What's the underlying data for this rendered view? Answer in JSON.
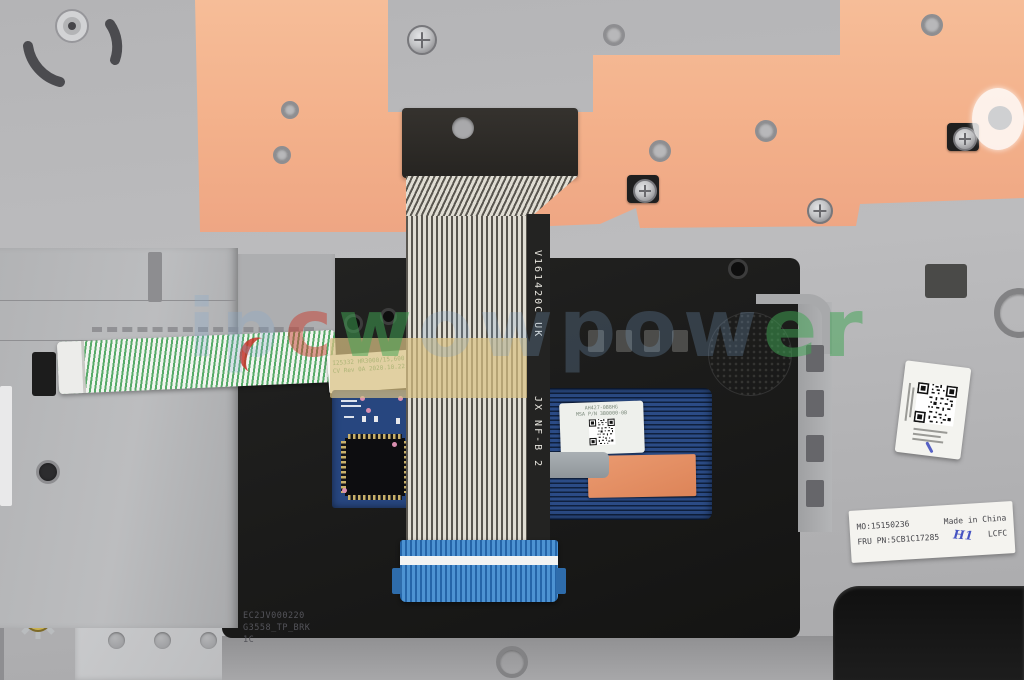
{
  "photo": {
    "description": "Top-down photo of a laptop palmrest / touchpad bracket assembly with a flat ribbon cable, adhesive orange sheet and part labels"
  },
  "watermark": {
    "seg1": "ip",
    "seg2": "c",
    "seg3": "w",
    "seg4": "owpow",
    "seg5": "er"
  },
  "ribbon": {
    "marking_upper": "V161420C UK",
    "marking_lower": "JX NF-B 2"
  },
  "ffc_label": {
    "line1": "I25332 HR3000/15,600",
    "line2": "CV Rev 0A 2020.10.22"
  },
  "touchpad_label": {
    "line1": "AH427-0B8HG",
    "line2": "MSA P/N 3B0000-0B"
  },
  "product_label": {
    "mo": "MO:15150236",
    "origin": "Made in China",
    "fru": "FRU PN:5CB1C17285",
    "handwritten": "H1",
    "vendor": "LCFC"
  },
  "molded_text": {
    "line1": "EC2JV000220",
    "line2": "G3558_TP_BRK",
    "line3": "1C"
  },
  "colors": {
    "palmrest_gray": "#b9babc",
    "adhesive_orange": "#f3b08a",
    "bracket_black": "#1d1d1c",
    "touchpad_blue": "#1c3a70",
    "pcb_blue": "#27467f",
    "ribbon_end_blue": "#2f72b5",
    "cable_stripe_green": "#57aa68",
    "label_white": "#f4f3ef",
    "handwriting_blue": "#4553c2",
    "watermark_red": "#c83e30",
    "watermark_green": "#42a454",
    "watermark_blue": "#80a8d0"
  }
}
